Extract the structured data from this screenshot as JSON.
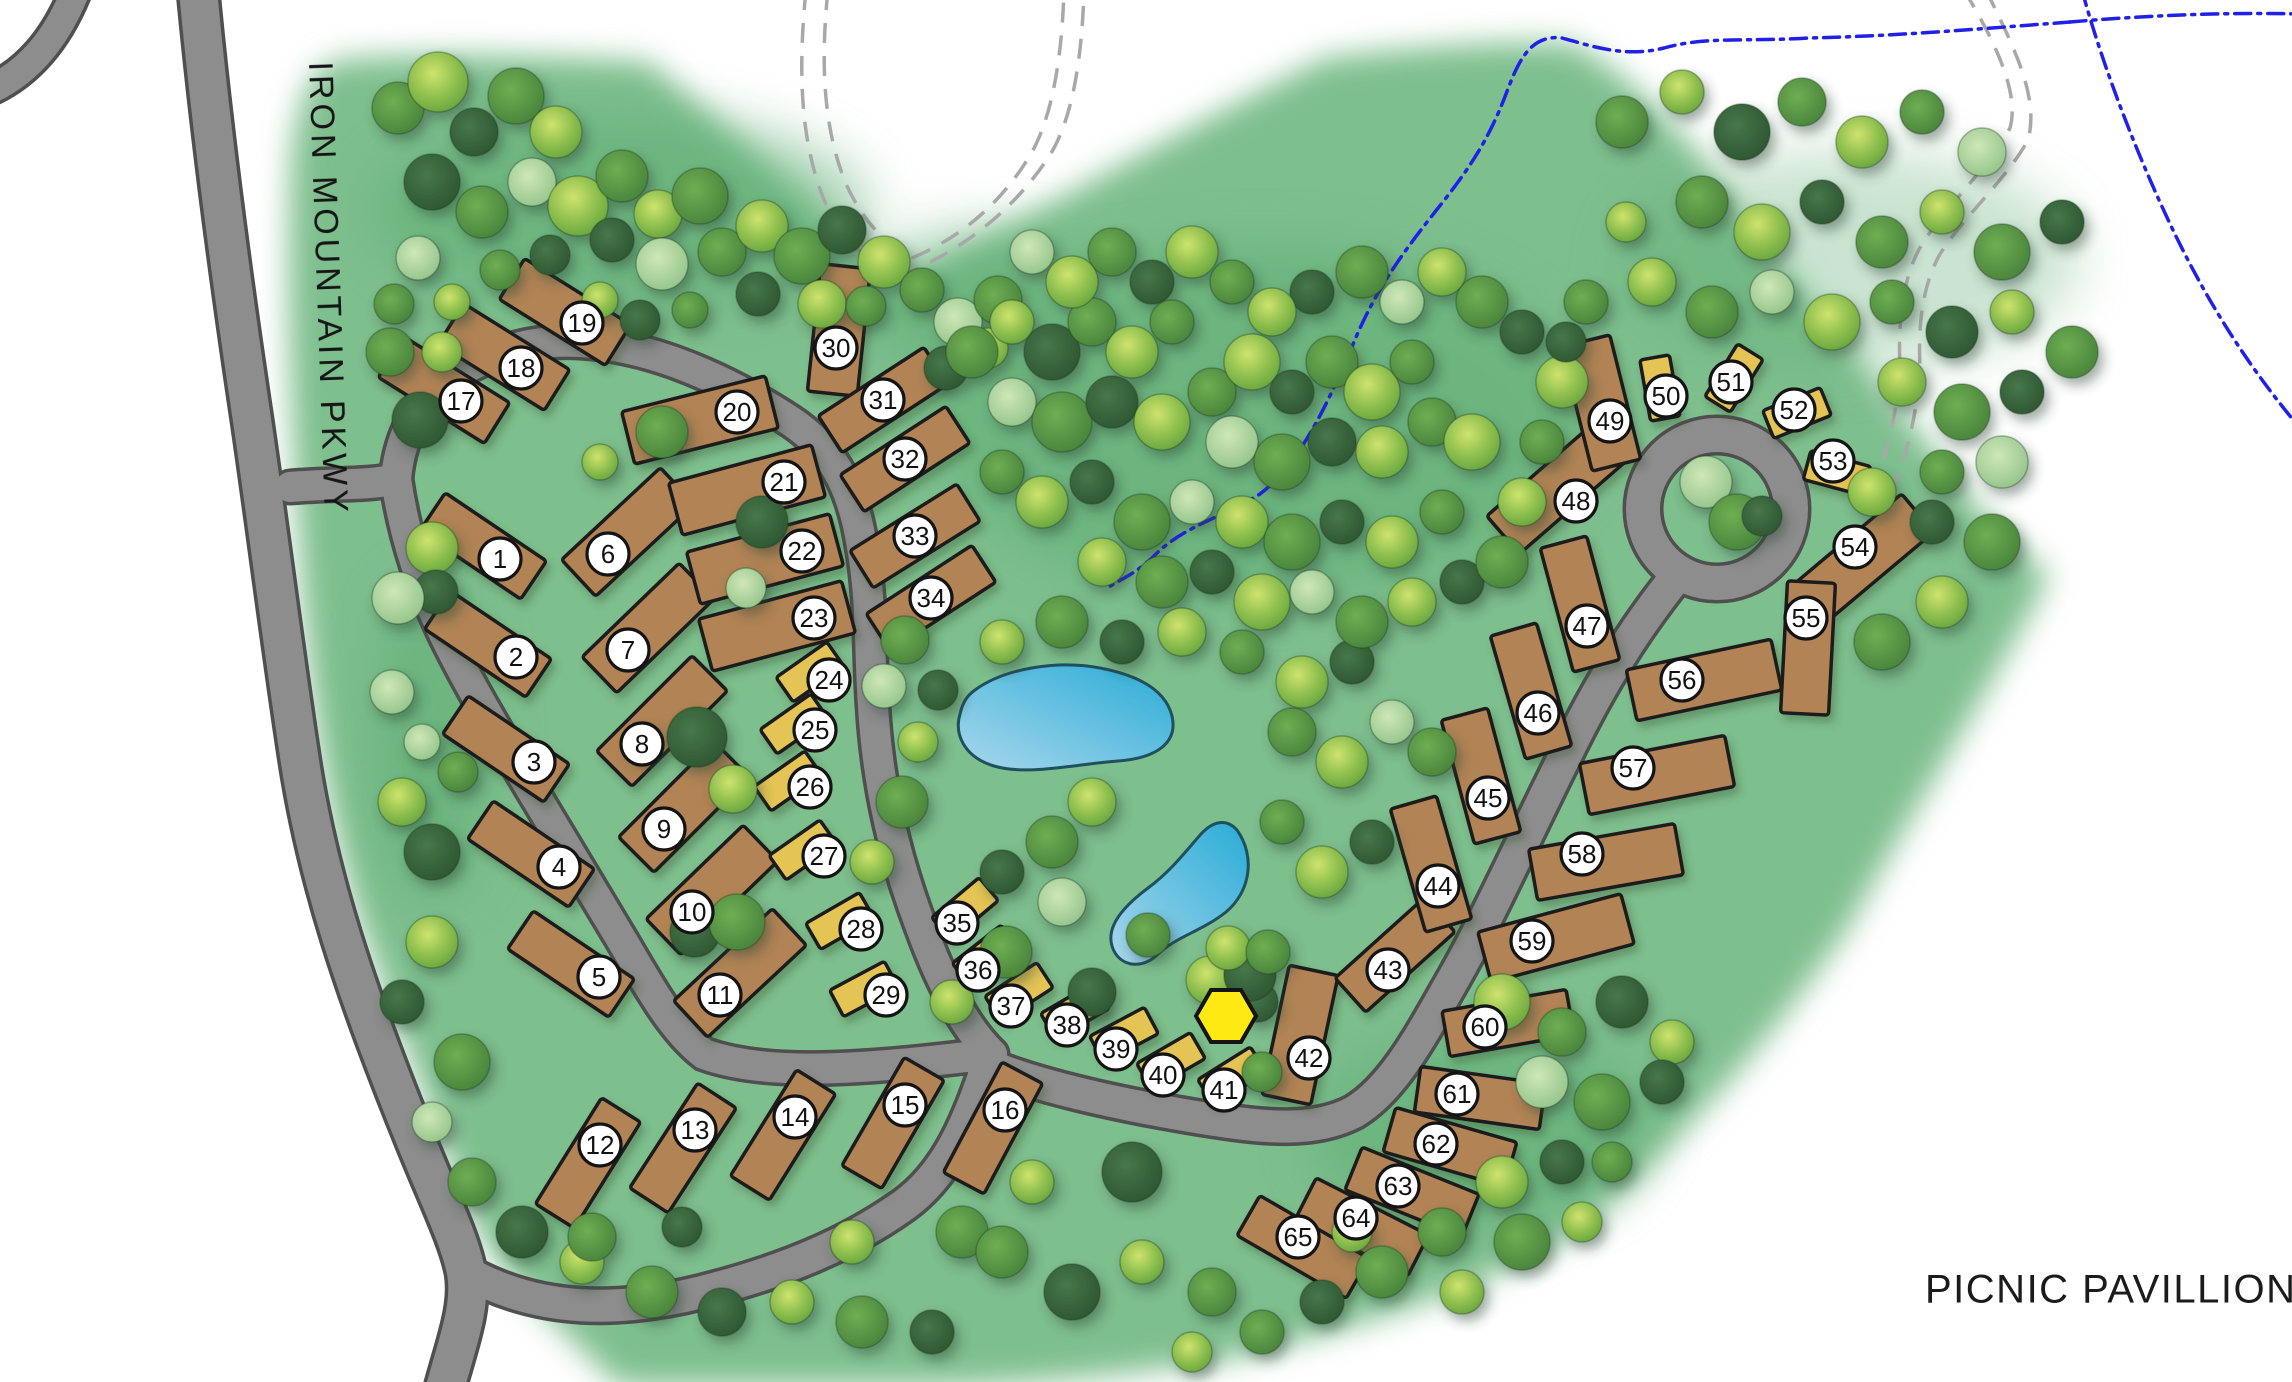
{
  "map": {
    "width": 2292,
    "height": 1382
  },
  "road_label": "IRON MOUNTAIN PKWY",
  "legend": {
    "symbol": "A",
    "label": "PICNIC PAVILLION"
  },
  "pavilion_marker": {
    "symbol": "A",
    "x": 1226,
    "y": 1016,
    "r": 30
  },
  "colors": {
    "green": "#7ebf8e",
    "canopy": "#5fae73",
    "road_fill": "#8d8d8d",
    "road_casing": "#4f4f4f",
    "lot_rv": "#b28455",
    "lot_tent": "#e4c454",
    "lot_outline": "#1c1c1c",
    "circle_fill": "#ffffff",
    "circle_stroke": "#141414",
    "number": "#111111",
    "marker_yellow": "#ffe912",
    "stream": "#2020e8",
    "trail": "#a8a8a8",
    "pond_light": "#a9d7ec",
    "pond_deep": "#29acd6",
    "pond_outline": "#20505e"
  },
  "lots": [
    [
      1,
      0,
      500,
      559,
      483,
      546,
      122,
      46,
      34
    ],
    [
      2,
      0,
      516,
      657,
      488,
      644,
      122,
      46,
      34
    ],
    [
      3,
      0,
      534,
      762,
      506,
      749,
      122,
      46,
      34
    ],
    [
      4,
      0,
      559,
      867,
      531,
      854,
      122,
      46,
      34
    ],
    [
      5,
      0,
      599,
      977,
      571,
      964,
      122,
      46,
      34
    ],
    [
      6,
      0,
      608,
      554,
      628,
      532,
      135,
      50,
      -43
    ],
    [
      7,
      0,
      628,
      650,
      648,
      628,
      135,
      50,
      -44
    ],
    [
      8,
      0,
      642,
      744,
      662,
      721,
      135,
      50,
      -45
    ],
    [
      9,
      0,
      664,
      829,
      684,
      807,
      135,
      50,
      -45
    ],
    [
      10,
      0,
      692,
      912,
      712,
      890,
      135,
      50,
      -44
    ],
    [
      11,
      0,
      720,
      995,
      740,
      973,
      135,
      50,
      -43
    ],
    [
      12,
      0,
      600,
      1145,
      588,
      1163,
      125,
      46,
      -58
    ],
    [
      13,
      0,
      695,
      1130,
      683,
      1148,
      125,
      46,
      -57
    ],
    [
      14,
      0,
      795,
      1117,
      783,
      1135,
      125,
      46,
      -58
    ],
    [
      15,
      0,
      905,
      1105,
      893,
      1123,
      125,
      46,
      -60
    ],
    [
      16,
      0,
      1005,
      1110,
      993,
      1128,
      125,
      46,
      -62
    ],
    [
      17,
      0,
      461,
      401,
      444,
      390,
      125,
      48,
      32
    ],
    [
      18,
      0,
      521,
      368,
      504,
      357,
      125,
      48,
      32
    ],
    [
      19,
      0,
      582,
      323,
      565,
      312,
      125,
      48,
      32
    ],
    [
      20,
      0,
      737,
      412,
      700,
      420,
      148,
      54,
      -14
    ],
    [
      21,
      0,
      784,
      482,
      747,
      490,
      148,
      54,
      -15
    ],
    [
      22,
      0,
      802,
      551,
      765,
      559,
      148,
      54,
      -15
    ],
    [
      23,
      0,
      814,
      618,
      777,
      626,
      148,
      54,
      -15
    ],
    [
      24,
      1,
      829,
      680,
      810,
      672,
      62,
      30,
      -35
    ],
    [
      25,
      1,
      815,
      730,
      794,
      724,
      62,
      30,
      -35
    ],
    [
      26,
      1,
      810,
      787,
      788,
      781,
      62,
      30,
      -35
    ],
    [
      27,
      1,
      824,
      856,
      803,
      850,
      62,
      30,
      -35
    ],
    [
      28,
      1,
      861,
      929,
      840,
      921,
      62,
      30,
      -30
    ],
    [
      29,
      1,
      886,
      995,
      864,
      989,
      62,
      30,
      -28
    ],
    [
      30,
      0,
      836,
      348,
      839,
      330,
      128,
      50,
      96
    ],
    [
      31,
      0,
      883,
      400,
      883,
      400,
      126,
      44,
      -33
    ],
    [
      32,
      0,
      905,
      459,
      905,
      459,
      126,
      44,
      -33
    ],
    [
      33,
      0,
      915,
      536,
      915,
      536,
      126,
      44,
      -32
    ],
    [
      34,
      0,
      931,
      598,
      931,
      598,
      126,
      44,
      -33
    ],
    [
      35,
      1,
      957,
      923,
      965,
      909,
      62,
      30,
      -40
    ],
    [
      36,
      1,
      978,
      970,
      986,
      956,
      62,
      30,
      -38
    ],
    [
      37,
      1,
      1011,
      1006,
      1019,
      992,
      62,
      30,
      -33
    ],
    [
      38,
      1,
      1067,
      1025,
      1075,
      1011,
      62,
      30,
      -30
    ],
    [
      39,
      1,
      1116,
      1049,
      1124,
      1035,
      62,
      30,
      -28
    ],
    [
      40,
      1,
      1163,
      1075,
      1171,
      1061,
      62,
      30,
      -30
    ],
    [
      41,
      1,
      1224,
      1090,
      1232,
      1076,
      62,
      30,
      -32
    ],
    [
      42,
      0,
      1309,
      1058,
      1300,
      1035,
      132,
      50,
      -78
    ],
    [
      43,
      0,
      1388,
      970,
      1395,
      955,
      120,
      46,
      -42
    ],
    [
      44,
      0,
      1438,
      886,
      1431,
      864,
      128,
      48,
      74
    ],
    [
      45,
      0,
      1488,
      798,
      1481,
      776,
      128,
      48,
      75
    ],
    [
      46,
      0,
      1538,
      713,
      1531,
      691,
      128,
      48,
      74
    ],
    [
      47,
      0,
      1587,
      626,
      1580,
      604,
      128,
      48,
      75
    ],
    [
      48,
      0,
      1576,
      501,
      1556,
      489,
      140,
      50,
      -41
    ],
    [
      49,
      0,
      1610,
      421,
      1601,
      403,
      128,
      50,
      76
    ],
    [
      50,
      1,
      1666,
      396,
      1660,
      388,
      62,
      30,
      80
    ],
    [
      51,
      1,
      1731,
      382,
      1734,
      378,
      62,
      30,
      -58
    ],
    [
      52,
      1,
      1794,
      410,
      1797,
      413,
      62,
      30,
      -22
    ],
    [
      53,
      1,
      1833,
      461,
      1837,
      473,
      62,
      30,
      15
    ],
    [
      54,
      0,
      1855,
      547,
      1864,
      558,
      140,
      50,
      -40
    ],
    [
      55,
      0,
      1806,
      618,
      1808,
      648,
      132,
      48,
      93
    ],
    [
      56,
      0,
      1682,
      680,
      1704,
      680,
      148,
      52,
      -12
    ],
    [
      57,
      0,
      1633,
      768,
      1657,
      775,
      148,
      52,
      -11
    ],
    [
      58,
      0,
      1582,
      854,
      1606,
      862,
      148,
      52,
      -10
    ],
    [
      59,
      0,
      1532,
      941,
      1556,
      938,
      148,
      52,
      -15
    ],
    [
      60,
      0,
      1485,
      1027,
      1508,
      1023,
      126,
      46,
      -10
    ],
    [
      61,
      0,
      1457,
      1094,
      1480,
      1098,
      126,
      46,
      8
    ],
    [
      62,
      0,
      1436,
      1144,
      1450,
      1147,
      126,
      46,
      16
    ],
    [
      63,
      0,
      1398,
      1186,
      1412,
      1192,
      126,
      46,
      22
    ],
    [
      64,
      0,
      1356,
      1218,
      1362,
      1227,
      126,
      46,
      27
    ],
    [
      65,
      0,
      1298,
      1237,
      1303,
      1247,
      126,
      46,
      30
    ]
  ],
  "trees": [
    [
      398,
      108,
      26,
      1
    ],
    [
      438,
      82,
      30,
      2
    ],
    [
      474,
      132,
      24,
      0
    ],
    [
      516,
      96,
      28,
      1
    ],
    [
      556,
      132,
      26,
      2
    ],
    [
      432,
      182,
      28,
      0
    ],
    [
      482,
      212,
      26,
      1
    ],
    [
      532,
      182,
      24,
      3
    ],
    [
      578,
      206,
      30,
      2
    ],
    [
      622,
      176,
      26,
      1
    ],
    [
      612,
      240,
      22,
      0
    ],
    [
      658,
      214,
      24,
      2
    ],
    [
      700,
      196,
      28,
      1
    ],
    [
      662,
      264,
      26,
      3
    ],
    [
      722,
      252,
      24,
      1
    ],
    [
      762,
      226,
      26,
      2
    ],
    [
      802,
      256,
      28,
      1
    ],
    [
      842,
      230,
      24,
      0
    ],
    [
      884,
      262,
      26,
      2
    ],
    [
      922,
      290,
      22,
      1
    ],
    [
      758,
      294,
      22,
      0
    ],
    [
      822,
      304,
      24,
      2
    ],
    [
      866,
      306,
      20,
      1
    ],
    [
      958,
      322,
      24,
      3
    ],
    [
      998,
      300,
      24,
      1
    ],
    [
      946,
      368,
      22,
      0
    ],
    [
      988,
      348,
      20,
      2
    ],
    [
      418,
      258,
      22,
      3
    ],
    [
      394,
      304,
      20,
      1
    ],
    [
      452,
      302,
      18,
      2
    ],
    [
      500,
      270,
      20,
      1
    ],
    [
      600,
      300,
      18,
      2
    ],
    [
      640,
      320,
      20,
      0
    ],
    [
      550,
      255,
      20,
      0
    ],
    [
      690,
      310,
      18,
      1
    ],
    [
      420,
      420,
      28,
      0
    ],
    [
      432,
      548,
      26,
      2
    ],
    [
      436,
      592,
      22,
      0
    ],
    [
      398,
      598,
      26,
      3
    ],
    [
      392,
      692,
      22,
      3
    ],
    [
      422,
      742,
      18,
      3
    ],
    [
      402,
      802,
      24,
      2
    ],
    [
      432,
      852,
      28,
      0
    ],
    [
      458,
      772,
      20,
      1
    ],
    [
      390,
      352,
      24,
      1
    ],
    [
      442,
      352,
      20,
      2
    ],
    [
      662,
      432,
      26,
      1
    ],
    [
      762,
      522,
      26,
      0
    ],
    [
      746,
      588,
      20,
      3
    ],
    [
      697,
      737,
      30,
      0
    ],
    [
      733,
      789,
      24,
      2
    ],
    [
      695,
      932,
      25,
      0
    ],
    [
      737,
      922,
      28,
      1
    ],
    [
      643,
      742,
      20,
      2
    ],
    [
      600,
      462,
      18,
      2
    ],
    [
      905,
      640,
      24,
      1
    ],
    [
      884,
      686,
      22,
      3
    ],
    [
      938,
      690,
      20,
      0
    ],
    [
      902,
      802,
      26,
      1
    ],
    [
      872,
      862,
      22,
      2
    ],
    [
      918,
      742,
      20,
      2
    ],
    [
      1002,
      642,
      22,
      2
    ],
    [
      1062,
      622,
      26,
      1
    ],
    [
      1122,
      642,
      22,
      0
    ],
    [
      1182,
      632,
      24,
      2
    ],
    [
      1242,
      652,
      22,
      1
    ],
    [
      1302,
      682,
      26,
      2
    ],
    [
      1352,
      662,
      22,
      0
    ],
    [
      1292,
      732,
      24,
      1
    ],
    [
      1342,
      762,
      26,
      2
    ],
    [
      1392,
      722,
      22,
      3
    ],
    [
      1432,
      752,
      24,
      1
    ],
    [
      1092,
      802,
      24,
      2
    ],
    [
      1052,
      842,
      26,
      1
    ],
    [
      1002,
      872,
      22,
      0
    ],
    [
      1062,
      902,
      24,
      3
    ],
    [
      1282,
      822,
      22,
      1
    ],
    [
      1322,
      872,
      26,
      2
    ],
    [
      1372,
      842,
      22,
      0
    ],
    [
      1006,
      952,
      26,
      1
    ],
    [
      952,
      1002,
      22,
      2
    ],
    [
      1092,
      992,
      24,
      0
    ],
    [
      1148,
      935,
      22,
      1
    ],
    [
      1210,
      980,
      24,
      2
    ],
    [
      1258,
      1002,
      20,
      0
    ],
    [
      972,
      352,
      26,
      1
    ],
    [
      1012,
      322,
      22,
      2
    ],
    [
      1052,
      352,
      28,
      0
    ],
    [
      1092,
      322,
      24,
      1
    ],
    [
      1132,
      352,
      26,
      2
    ],
    [
      1172,
      322,
      22,
      1
    ],
    [
      1012,
      402,
      24,
      3
    ],
    [
      1062,
      422,
      30,
      1
    ],
    [
      1112,
      402,
      26,
      0
    ],
    [
      1162,
      422,
      28,
      2
    ],
    [
      1212,
      392,
      24,
      1
    ],
    [
      1252,
      362,
      28,
      2
    ],
    [
      1292,
      392,
      22,
      0
    ],
    [
      1332,
      362,
      26,
      1
    ],
    [
      1372,
      392,
      28,
      2
    ],
    [
      1412,
      362,
      22,
      1
    ],
    [
      1232,
      442,
      26,
      3
    ],
    [
      1282,
      462,
      28,
      1
    ],
    [
      1332,
      442,
      24,
      0
    ],
    [
      1382,
      452,
      26,
      2
    ],
    [
      1432,
      422,
      24,
      1
    ],
    [
      1472,
      442,
      28,
      2
    ],
    [
      1002,
      472,
      22,
      1
    ],
    [
      1042,
      502,
      26,
      2
    ],
    [
      1092,
      482,
      22,
      0
    ],
    [
      1142,
      522,
      28,
      1
    ],
    [
      1192,
      502,
      22,
      3
    ],
    [
      1242,
      522,
      26,
      2
    ],
    [
      1292,
      542,
      28,
      1
    ],
    [
      1342,
      522,
      22,
      0
    ],
    [
      1392,
      542,
      26,
      2
    ],
    [
      1442,
      512,
      22,
      1
    ],
    [
      1102,
      562,
      24,
      2
    ],
    [
      1162,
      582,
      26,
      1
    ],
    [
      1212,
      572,
      22,
      0
    ],
    [
      1262,
      602,
      28,
      2
    ],
    [
      1312,
      592,
      22,
      3
    ],
    [
      1362,
      622,
      26,
      1
    ],
    [
      1412,
      602,
      24,
      2
    ],
    [
      1462,
      582,
      22,
      0
    ],
    [
      1502,
      562,
      26,
      1
    ],
    [
      1522,
      502,
      24,
      2
    ],
    [
      1542,
      442,
      22,
      1
    ],
    [
      1562,
      382,
      26,
      2
    ],
    [
      1522,
      332,
      22,
      0
    ],
    [
      1482,
      302,
      26,
      1
    ],
    [
      1442,
      272,
      24,
      2
    ],
    [
      1402,
      302,
      22,
      3
    ],
    [
      1362,
      272,
      26,
      1
    ],
    [
      1312,
      292,
      22,
      0
    ],
    [
      1272,
      312,
      24,
      2
    ],
    [
      1232,
      282,
      22,
      1
    ],
    [
      1192,
      252,
      26,
      2
    ],
    [
      1152,
      282,
      22,
      0
    ],
    [
      1112,
      252,
      24,
      1
    ],
    [
      1072,
      282,
      26,
      2
    ],
    [
      1032,
      252,
      22,
      3
    ],
    [
      1622,
      122,
      26,
      1
    ],
    [
      1682,
      92,
      22,
      2
    ],
    [
      1742,
      132,
      28,
      0
    ],
    [
      1802,
      102,
      24,
      1
    ],
    [
      1862,
      142,
      26,
      2
    ],
    [
      1922,
      112,
      22,
      1
    ],
    [
      1982,
      152,
      24,
      3
    ],
    [
      1702,
      202,
      26,
      1
    ],
    [
      1762,
      232,
      28,
      2
    ],
    [
      1822,
      202,
      22,
      0
    ],
    [
      1882,
      242,
      26,
      1
    ],
    [
      1942,
      212,
      22,
      2
    ],
    [
      2002,
      252,
      28,
      1
    ],
    [
      2062,
      222,
      22,
      0
    ],
    [
      1652,
      282,
      24,
      2
    ],
    [
      1712,
      312,
      26,
      1
    ],
    [
      1772,
      292,
      22,
      3
    ],
    [
      1832,
      322,
      28,
      2
    ],
    [
      1892,
      302,
      22,
      1
    ],
    [
      1952,
      332,
      26,
      0
    ],
    [
      2012,
      312,
      22,
      2
    ],
    [
      2072,
      352,
      26,
      1
    ],
    [
      1902,
      382,
      24,
      2
    ],
    [
      1962,
      412,
      28,
      1
    ],
    [
      2022,
      392,
      22,
      0
    ],
    [
      1942,
      472,
      22,
      1
    ],
    [
      2002,
      462,
      26,
      3
    ],
    [
      1992,
      542,
      28,
      1
    ],
    [
      1932,
      522,
      22,
      0
    ],
    [
      1872,
      492,
      24,
      2
    ],
    [
      1942,
      602,
      26,
      2
    ],
    [
      1882,
      642,
      28,
      1
    ],
    [
      1626,
      222,
      20,
      2
    ],
    [
      1586,
      302,
      22,
      1
    ],
    [
      1566,
      342,
      20,
      0
    ],
    [
      1502,
      1002,
      28,
      2
    ],
    [
      1562,
      1032,
      24,
      1
    ],
    [
      1622,
      1002,
      26,
      0
    ],
    [
      1672,
      1042,
      22,
      2
    ],
    [
      1542,
      1082,
      26,
      3
    ],
    [
      1602,
      1102,
      28,
      1
    ],
    [
      1662,
      1082,
      22,
      0
    ],
    [
      1442,
      1232,
      24,
      1
    ],
    [
      1502,
      1182,
      26,
      2
    ],
    [
      1562,
      1162,
      22,
      0
    ],
    [
      1522,
      1242,
      28,
      1
    ],
    [
      1462,
      1292,
      22,
      2
    ],
    [
      1382,
      1272,
      26,
      1
    ],
    [
      1322,
      1302,
      22,
      0
    ],
    [
      1582,
      1222,
      20,
      2
    ],
    [
      1352,
      1232,
      20,
      2
    ],
    [
      1612,
      1162,
      20,
      1
    ],
    [
      432,
      942,
      26,
      2
    ],
    [
      402,
      1002,
      22,
      0
    ],
    [
      462,
      1062,
      28,
      1
    ],
    [
      432,
      1122,
      20,
      3
    ],
    [
      472,
      1182,
      24,
      1
    ],
    [
      522,
      1232,
      26,
      0
    ],
    [
      582,
      1262,
      22,
      2
    ],
    [
      652,
      1292,
      26,
      1
    ],
    [
      722,
      1312,
      24,
      0
    ],
    [
      792,
      1302,
      22,
      2
    ],
    [
      862,
      1322,
      26,
      1
    ],
    [
      932,
      1332,
      22,
      0
    ],
    [
      592,
      1237,
      24,
      1
    ],
    [
      682,
      1227,
      20,
      0
    ],
    [
      852,
      1242,
      22,
      2
    ],
    [
      962,
      1232,
      26,
      1
    ],
    [
      1002,
      1252,
      26,
      1
    ],
    [
      1072,
      1292,
      28,
      0
    ],
    [
      1142,
      1262,
      22,
      2
    ],
    [
      1212,
      1292,
      24,
      1
    ],
    [
      1132,
      1172,
      30,
      0
    ],
    [
      1262,
      1332,
      22,
      1
    ],
    [
      1192,
      1352,
      20,
      2
    ],
    [
      1032,
      1182,
      22,
      2
    ],
    [
      1706,
      482,
      26,
      3
    ],
    [
      1737,
      522,
      28,
      1
    ],
    [
      1762,
      516,
      20,
      0
    ],
    [
      1250,
      975,
      26,
      0
    ],
    [
      1228,
      948,
      22,
      2
    ],
    [
      1262,
      1072,
      20,
      1
    ],
    [
      1268,
      952,
      22,
      1
    ]
  ]
}
